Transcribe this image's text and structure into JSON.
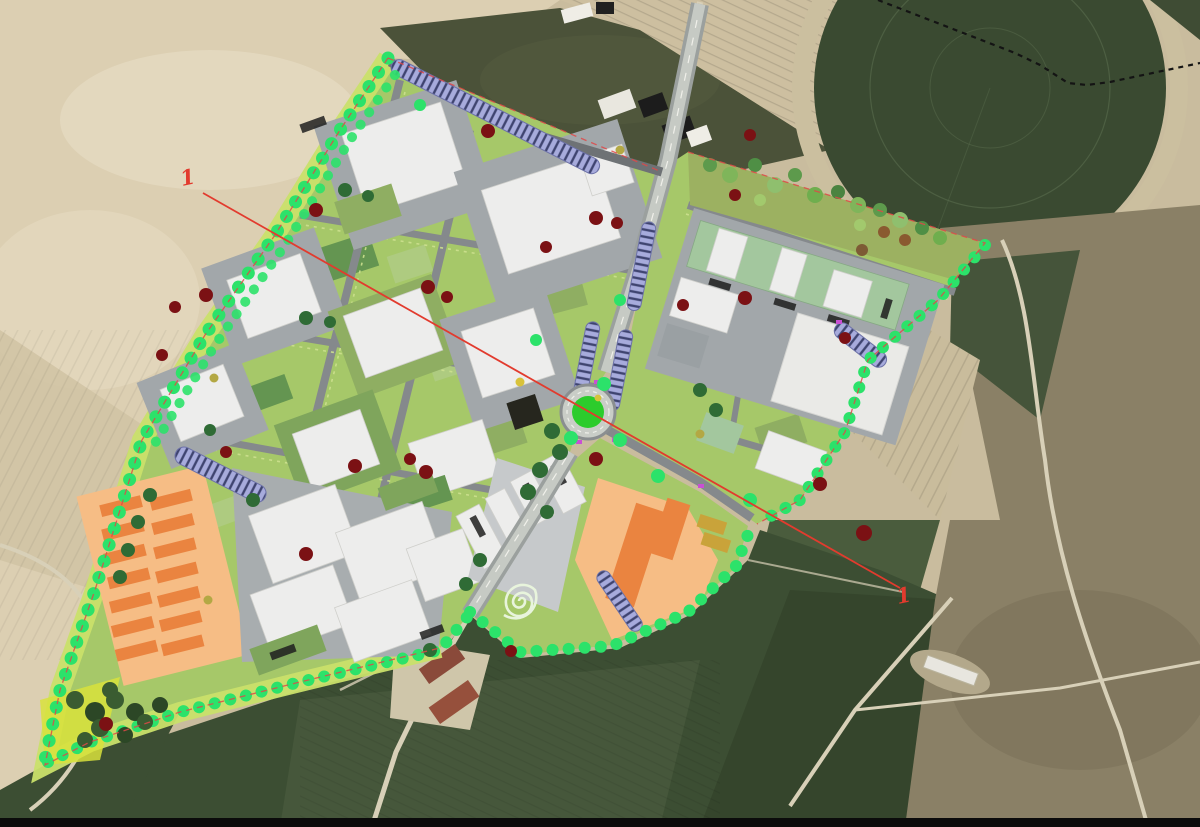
{
  "map": {
    "kind": "aerial-photo-with-masterplan-overlay",
    "annotations": {
      "section_start_label": "1",
      "section_end_label": "1"
    },
    "colors": {
      "field-beige": "#dccfb2",
      "field-beige-light": "#e8ddc6",
      "field-tan": "#c9bc9e",
      "field-dark": "#3c4e33",
      "field-dark2": "#46573b",
      "field-pivot": "#3a4a31",
      "scrub-dark": "#4b5239",
      "scrub-brown": "#8a8066",
      "olive-grove": "#45543a",
      "road-existing": "#d8d0b8",
      "plan-green": "#a6c869",
      "plan-green-light": "#c9e06a",
      "plot-green": "#8fae62",
      "plot-green-dark": "#649551",
      "plot-green-pale": "#aecb80",
      "road-gray": "#85898c",
      "road-dark": "#6e7275",
      "pad-gray": "#a2a7aa",
      "pad-light": "#c6c9cb",
      "bldg-white": "#ededec",
      "bldg-roof-green": "#a3c79e",
      "lavender": "#a7abdc",
      "lavender-dark": "#3f4470",
      "orange-field": "#f6bd85",
      "orange-bldg": "#ea8440",
      "ochre-bldg": "#c9a33a",
      "tree-bright": "#2ce26a",
      "tree-mid": "#55b04b",
      "tree-dark": "#2f6b35",
      "tree-red": "#7b1114",
      "tree-olive": "#b3a844",
      "roundabout-green": "#2ccc2c",
      "section-red": "#e23b2e",
      "letterbox-black": "#0b0b0b"
    }
  }
}
